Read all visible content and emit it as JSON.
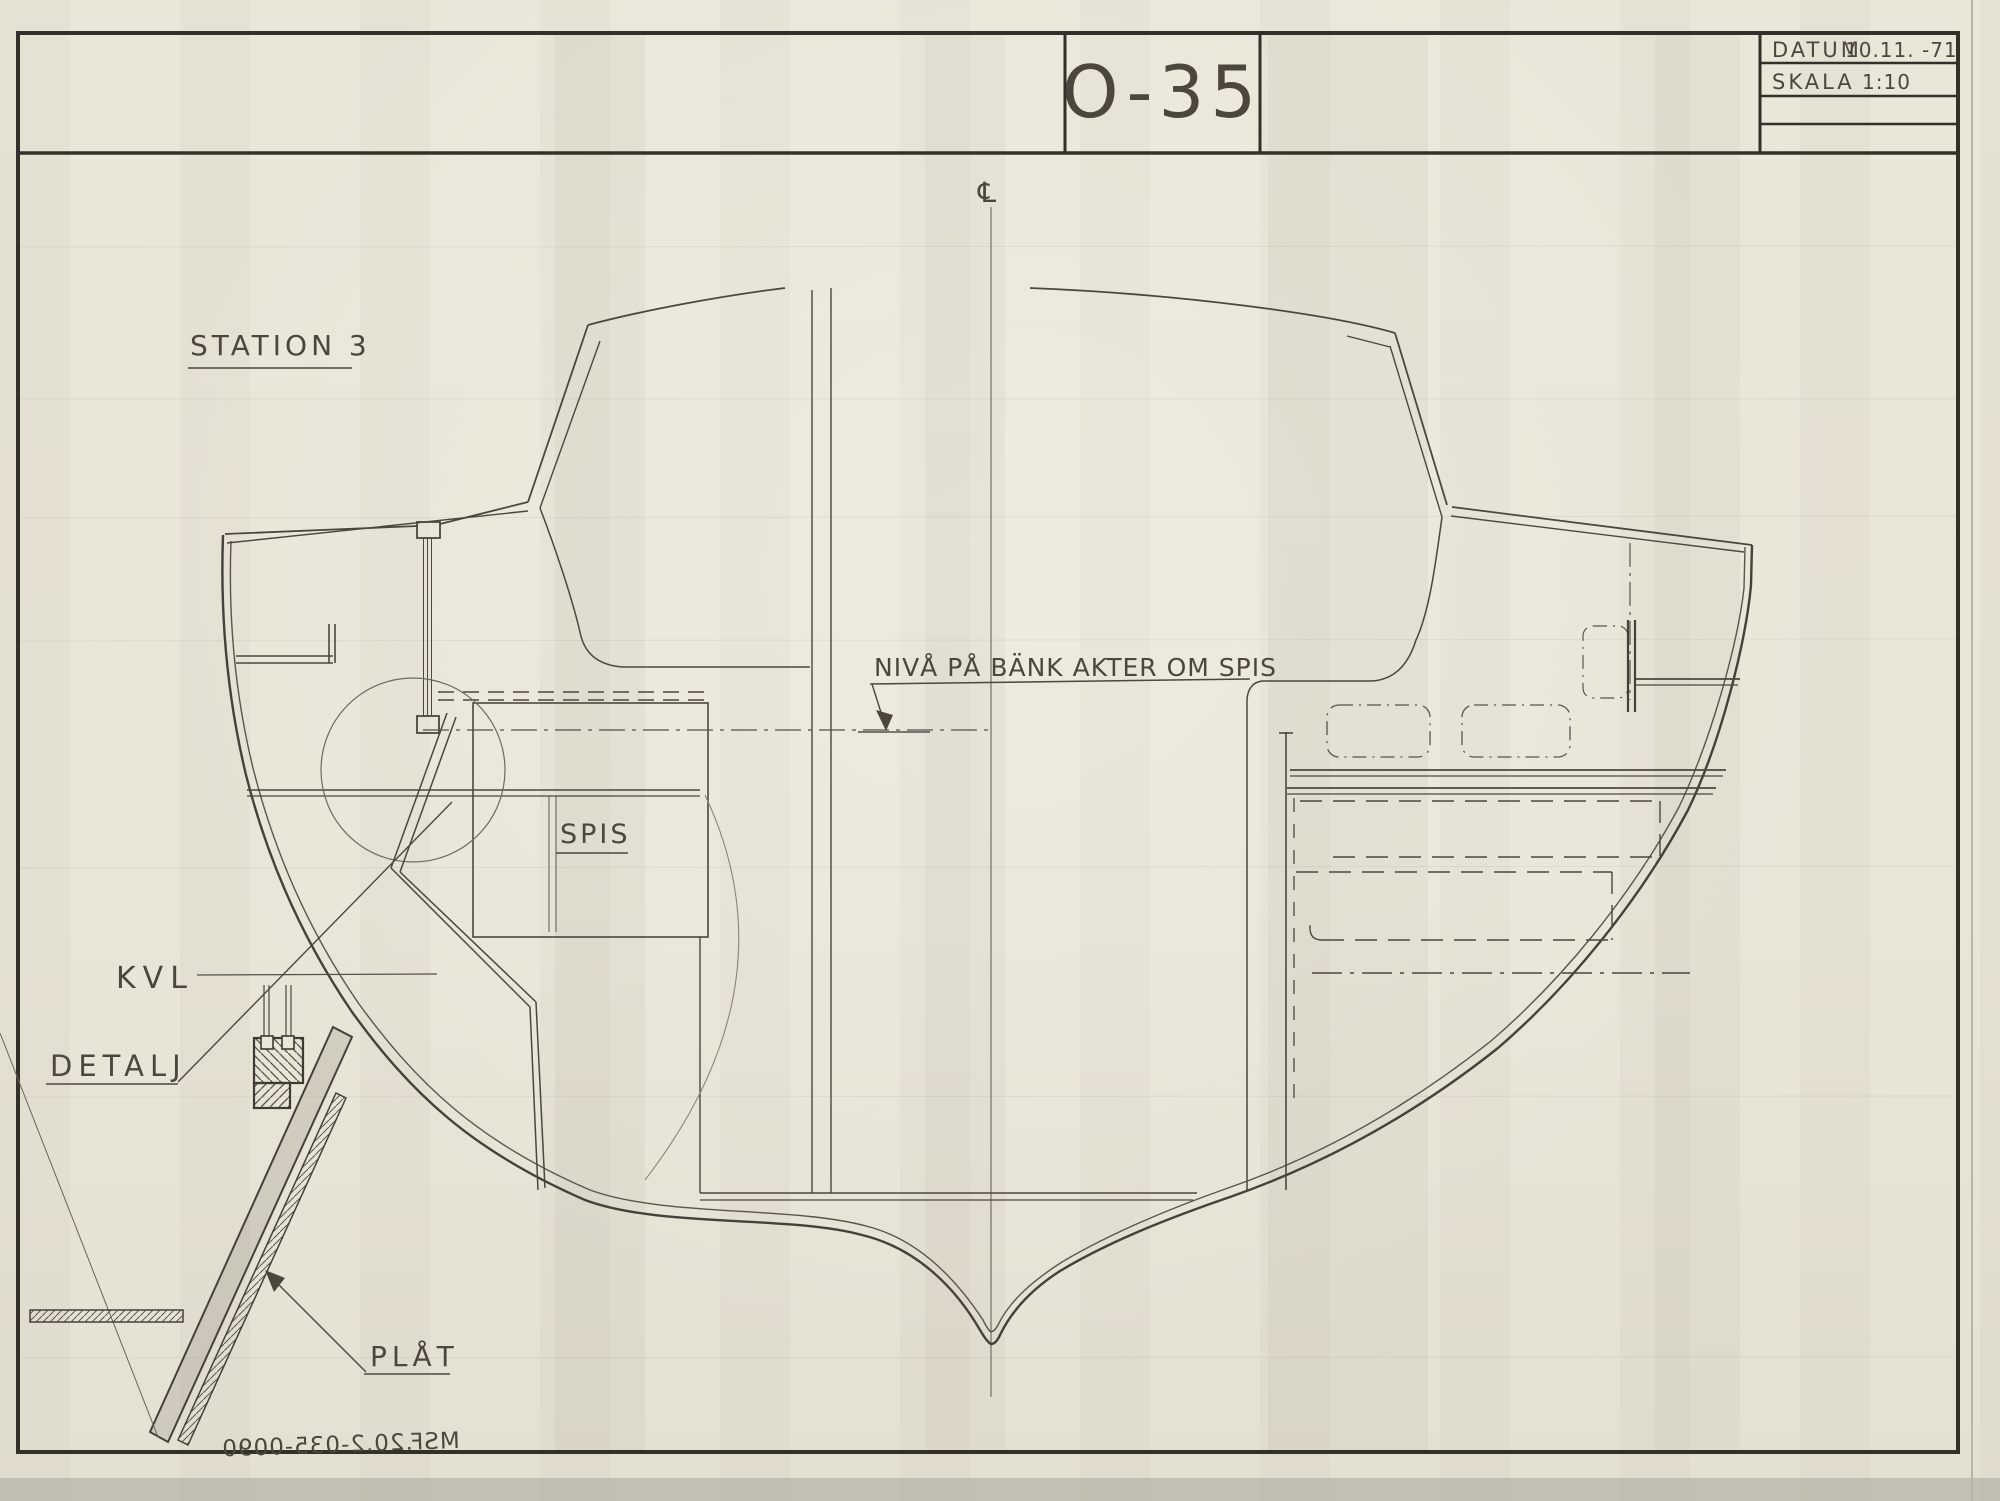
{
  "sheet": {
    "drawing_number": "O-35",
    "info_table": {
      "datum_label": "DATUM",
      "datum_value": "10.11. -71",
      "skala_label": "SKALA",
      "skala_value": "1:10"
    }
  },
  "labels": {
    "station": "STATION 3",
    "niva_line": "NIVÅ PÅ BÄNK AKTER OM SPIS",
    "spis": "SPIS",
    "kvl": "KVL",
    "detalj": "DETALJ",
    "plat": "PLÅT",
    "centerline_symbol": "℄",
    "doc_number_mirrored": "MSF.20.2-035-0090"
  },
  "colors": {
    "paper": "#eae6d8",
    "ink_border": "#33302a",
    "pencil_dark": "#4c463d",
    "pencil_medium": "#5d574d",
    "pencil_faint": "#8b8577"
  }
}
